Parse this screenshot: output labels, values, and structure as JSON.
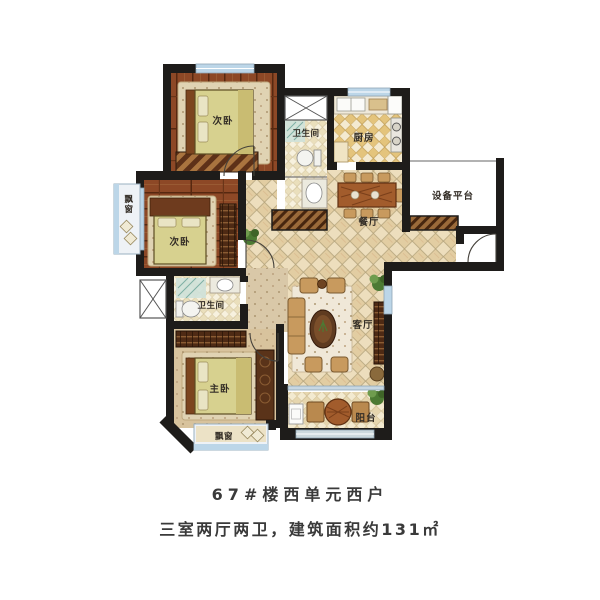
{
  "plan": {
    "rooms": {
      "bedroom_top": "次卧",
      "bedroom_middle": "次卧",
      "master_bedroom": "主卧",
      "bathroom_top": "卫生间",
      "bathroom_middle": "卫生间",
      "kitchen": "厨房",
      "dining_room": "餐厅",
      "living_room": "客厅",
      "balcony": "阳台",
      "equipment_platform": "设备平台",
      "bay_window_left": "飘窗",
      "bay_window_bottom": "飘窗"
    }
  },
  "caption": {
    "line1": "67#楼西单元西户",
    "line2": "三室两厅两卫，建筑面积约131㎡"
  },
  "colors": {
    "wall": "#1e1c1a",
    "wood_floor": "#8d4826",
    "bed": "#d7d18f",
    "tile_warm": "#eddebd",
    "kitchen_tile": "#e4c47c",
    "window_glass": "#bcd6e8",
    "sofa": "#c89a5e",
    "label_text": "#332d26",
    "caption_text": "#3a3a3a"
  }
}
